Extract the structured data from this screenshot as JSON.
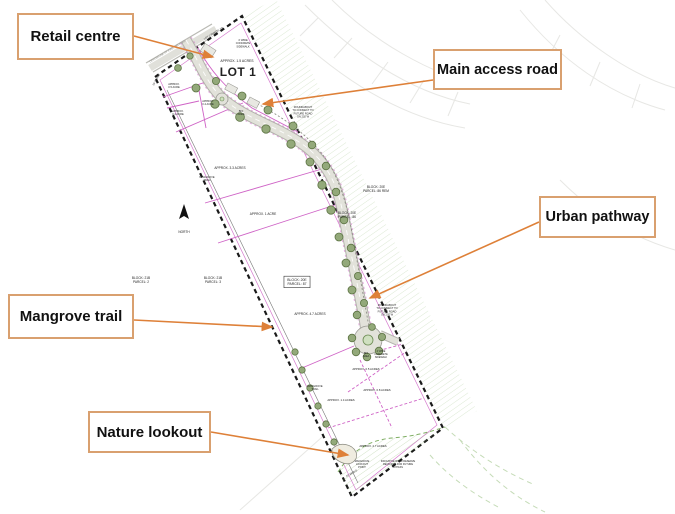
{
  "callouts": [
    {
      "label": "Retail centre"
    },
    {
      "label": "Main access road"
    },
    {
      "label": "Urban pathway"
    },
    {
      "label": "Mangrove trail"
    },
    {
      "label": "Nature lookout"
    }
  ],
  "colors": {
    "callout_border": "#d9a06f",
    "arrow": "#de8038",
    "parcel_line": "#cf63c6",
    "boundary": "#1a1a1a",
    "road_body": "#e2e2da",
    "road_edge": "#b3b3ac",
    "tree_fill": "#93a97a",
    "tree_stroke": "#5d7444",
    "hatch_green": "#9cc184",
    "island_green": "#cfe0c0"
  },
  "plan": {
    "labels": [
      {
        "t": "CENTERLINE OF EXISTING ROAD",
        "x": 168,
        "y": 52,
        "s": 2.6,
        "r": -31,
        "c": "#8a8a84"
      },
      {
        "t": "LOT 2 PARCEL TR",
        "x": 214,
        "y": 34,
        "s": 2.6,
        "r": -31
      },
      {
        "t": "4' WIDE\nCONCRETE\nSIDEWALK",
        "x": 243,
        "y": 41,
        "s": 2.6
      },
      {
        "t": "APPROX. 1.5 ACRES",
        "x": 237,
        "y": 62,
        "s": 3.4
      },
      {
        "t": "LOT 1",
        "x": 238,
        "y": 76,
        "s": 12,
        "b": true
      },
      {
        "t": "20' SWALE",
        "x": 157,
        "y": 80,
        "s": 2.6,
        "r": -62
      },
      {
        "t": "APPROX.\n0.5 ACRE",
        "x": 174,
        "y": 85,
        "s": 2.6
      },
      {
        "t": "APPROX.\n0.4 ACRE",
        "x": 208,
        "y": 102,
        "s": 2.6
      },
      {
        "t": "APPROX.\n0.4 ACRE",
        "x": 178,
        "y": 112,
        "s": 2.6
      },
      {
        "t": "BIO\nAREA",
        "x": 241,
        "y": 112,
        "s": 2.6
      },
      {
        "t": "ROUNDABOUT\nTO CONNECT TO\nFUTURE ROAD\nON 202 W",
        "x": 303,
        "y": 108,
        "s": 2.6
      },
      {
        "t": "BLOCK: 20E\nPARCEL: 86 REM",
        "x": 376,
        "y": 188,
        "s": 3.2
      },
      {
        "t": "BLOCK: 20E\nPARCEL: 86",
        "x": 347,
        "y": 214,
        "s": 3.2
      },
      {
        "t": "APPROX. 3.3 ACRES",
        "x": 230,
        "y": 169,
        "s": 3.2
      },
      {
        "t": "MANGROVE\nTRAIL",
        "x": 207,
        "y": 178,
        "s": 2.6
      },
      {
        "t": "APPROX. 1 ACRE",
        "x": 263,
        "y": 215,
        "s": 3.2
      },
      {
        "t": "BLOCK: 21B\nPARCEL: 2",
        "x": 141,
        "y": 279,
        "s": 3.2
      },
      {
        "t": "BLOCK: 21B\nPARCEL: 3",
        "x": 213,
        "y": 279,
        "s": 3.2
      },
      {
        "t": "BLOCK: 20E\nPARCEL: 87",
        "x": 297,
        "y": 281,
        "s": 3.4,
        "box": true
      },
      {
        "t": "APPROX. 4.7 ACRES",
        "x": 310,
        "y": 315,
        "s": 3.2
      },
      {
        "t": "ROUNDABOUT\nTO CONNECT TO\nFUTURE ROAD\nON 202 W",
        "x": 387,
        "y": 306,
        "s": 2.6
      },
      {
        "t": "BIO\nAREA",
        "x": 366,
        "y": 354,
        "s": 2.4
      },
      {
        "t": "4' WIDE\nCONCRETE\nSIDEWALK",
        "x": 381,
        "y": 352,
        "s": 2.4
      },
      {
        "t": "APPROX. 0.5 ACRES",
        "x": 366,
        "y": 370,
        "s": 2.8
      },
      {
        "t": "APPROX. 0.8 ACRES",
        "x": 377,
        "y": 391,
        "s": 2.8
      },
      {
        "t": "MANGROVE\nTRAIL",
        "x": 315,
        "y": 387,
        "s": 2.6
      },
      {
        "t": "APPROX. 1.4 ACRES",
        "x": 341,
        "y": 401,
        "s": 2.8
      },
      {
        "t": "APPROX. 2.7 ACRES",
        "x": 373,
        "y": 447,
        "s": 2.8
      },
      {
        "t": "MANGROVE\nLOOKOUT\nPOINT",
        "x": 362,
        "y": 462,
        "s": 2.5
      },
      {
        "t": "INDICATIVE ROAD RESERVE\nREQUIRED FOR FUTURE\nBYPASS",
        "x": 398,
        "y": 462,
        "s": 2.5
      },
      {
        "t": "20' SWALE",
        "x": 352,
        "y": 474,
        "s": 2.5,
        "r": -31
      },
      {
        "t": "NORTH",
        "x": 184,
        "y": 233,
        "s": 3.2
      }
    ]
  }
}
